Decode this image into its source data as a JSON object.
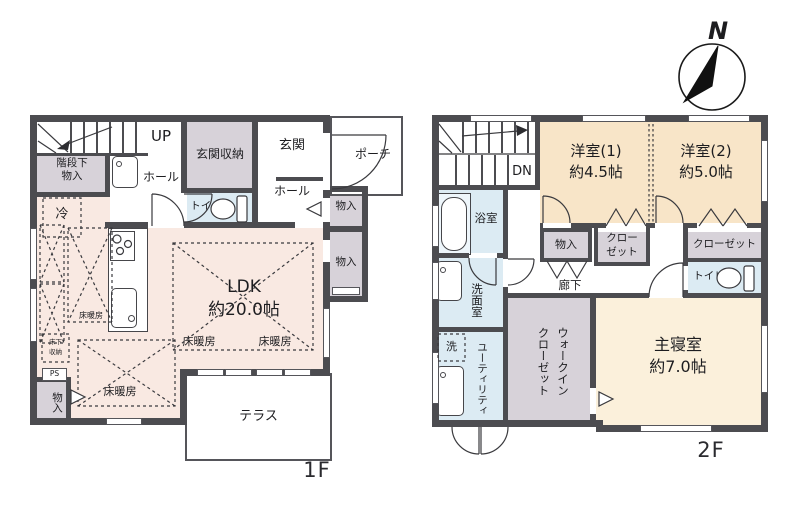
{
  "compass": {
    "label": "N"
  },
  "colors": {
    "wall": "#4c4c50",
    "ldk_pink": "#f9e9e2",
    "bedroom_peach": "#f8e5c8",
    "master_cream": "#fbf0db",
    "wet_blue": "#dcebf3",
    "closet_gray": "#d7d2d9"
  },
  "floor1": {
    "label": "1F",
    "stairs_up": "UP",
    "under_stair_storage": "階段下\n物入",
    "refrigerator": "冷",
    "hall_front": "ホール",
    "toilet": "トイレ",
    "entrance_storage": "玄関収納",
    "entrance": "玄関",
    "porch": "ポーチ",
    "hall_back": "ホール",
    "storage_east_1": "物入",
    "storage_east_2": "物入",
    "ldk": "LDK\n約20.0帖",
    "floor_heating": "床暖房",
    "underfloor_storage": "床下\n収納",
    "pipe_space": "PS",
    "storage_southwest": "物入",
    "terrace": "テラス"
  },
  "floor2": {
    "label": "2F",
    "stairs_down": "DN",
    "bathroom": "浴室",
    "western_room_1": "洋室(1)\n約4.5帖",
    "western_room_2": "洋室(2)\n約5.0帖",
    "storage": "物入",
    "closet_1": "クロー\nゼット",
    "closet_2": "クローゼット",
    "corridor": "廊下",
    "washroom": "洗面室",
    "washer": "洗",
    "utility": "ユーティリティ",
    "walk_in_closet": "ウォークイン\nクローゼット",
    "toilet": "トイレ",
    "master_bedroom": "主寝室\n約7.0帖"
  }
}
